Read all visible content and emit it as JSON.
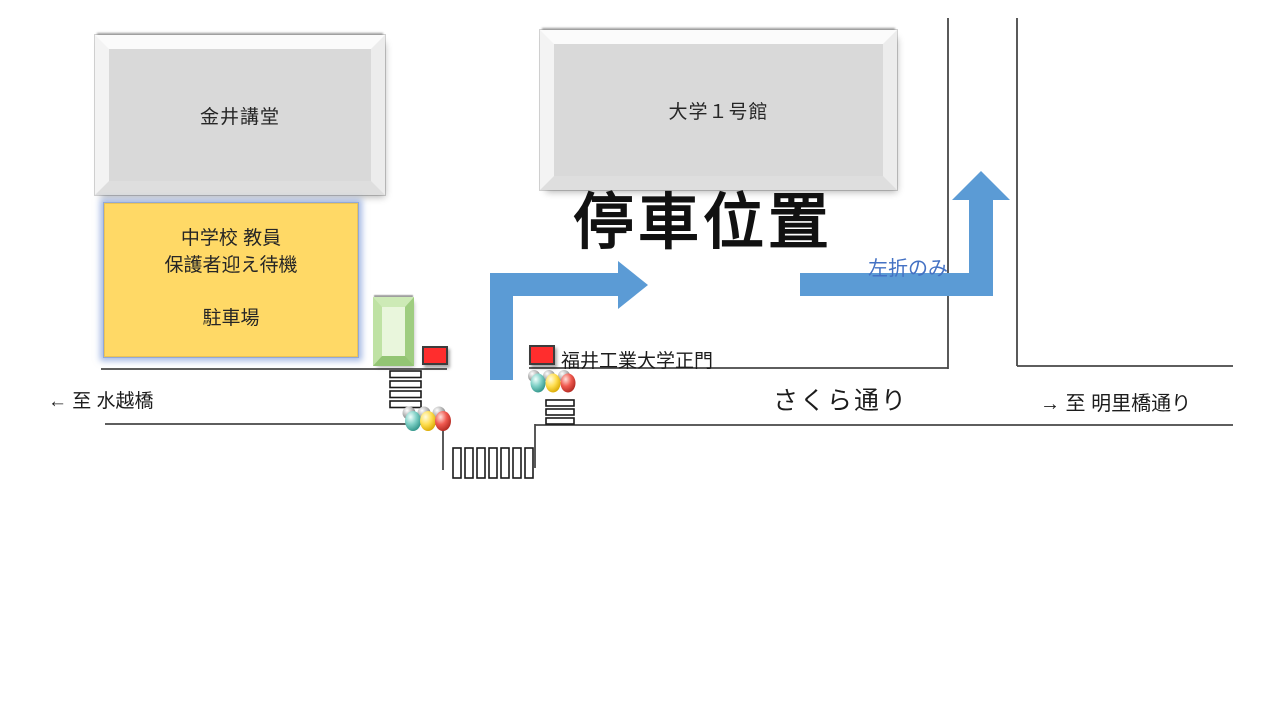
{
  "map_title": "停車位置",
  "buildings": {
    "kanai": {
      "label": "金井講堂"
    },
    "univ1": {
      "label": "大学１号館"
    }
  },
  "parking_box": {
    "line1": "中学校 教員",
    "line2": "保護者迎え待機",
    "line3": "駐車場",
    "fill_color": "#FFD966",
    "glow_color": "#5C82CD"
  },
  "route": {
    "left_turn_note": "左折のみ",
    "arrow_color": "#5B9BD5",
    "note_color": "#4472C4"
  },
  "main_gate": {
    "label": "福井工業大学正門",
    "marker_color": "#FF2D2D"
  },
  "streets": {
    "sakura": "さくら通り",
    "to_west": "← 至 水越橋",
    "to_east": "→ 至 明里橋通り"
  },
  "icons": {
    "traffic_light": "three glossy bulbs: teal / yellow / red with gray caps",
    "gate": "green beveled rectangle at campus entrance",
    "crosswalk": "striped zebra bars",
    "route_arrow": "thick light-blue elbow arrow"
  },
  "colors": {
    "building_fill": "#D9D9D9",
    "road_line": "#474747",
    "text": "#1A1A1A"
  }
}
